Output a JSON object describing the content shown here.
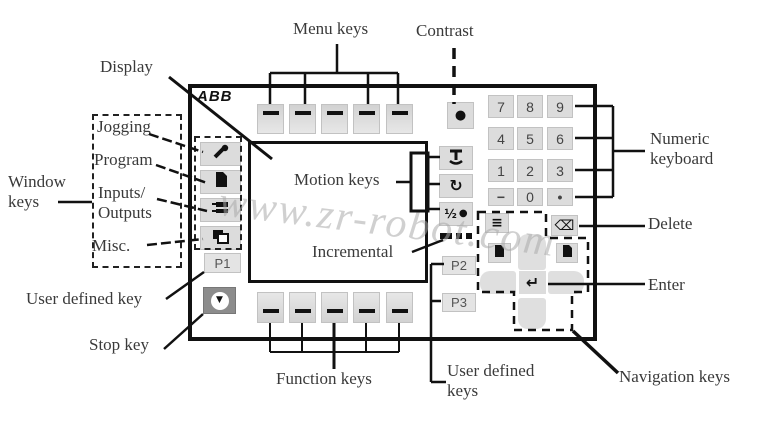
{
  "labels": {
    "display": "Display",
    "menu_keys": "Menu keys",
    "contrast": "Contrast",
    "window_keys_1": "Window",
    "window_keys_2": "keys",
    "jogging": "Jogging",
    "program": "Program",
    "inputs_outputs_1": "Inputs/",
    "inputs_outputs_2": "Outputs",
    "misc": "Misc.",
    "user_defined_key": "User defined key",
    "stop_key": "Stop key",
    "function_keys": "Function keys",
    "motion_keys": "Motion keys",
    "incremental": "Incremental",
    "user_defined_keys_1": "User defined",
    "user_defined_keys_2": "keys",
    "numeric_keyboard_1": "Numeric",
    "numeric_keyboard_2": "keyboard",
    "delete": "Delete",
    "enter": "Enter",
    "navigation_keys": "Navigation keys"
  },
  "watermark": "www.zr-robot.com",
  "logo": "ABB",
  "pendant": {
    "p_keys": [
      "P1",
      "P2",
      "P3"
    ],
    "keypad": [
      "7",
      "8",
      "9",
      "4",
      "5",
      "6",
      "1",
      "2",
      "3",
      "−",
      "0",
      "•"
    ],
    "icons": {
      "contrast": "●",
      "enter": "↵",
      "delete": "⌫",
      "list": "≡",
      "reorient": "↻",
      "axis_half": "½",
      "axis_dot": "●",
      "stop": "▼"
    }
  },
  "colors": {
    "key_bg": "#dcdcdc",
    "stop_key_bg": "#8c8c8c",
    "line": "#111111",
    "label_text": "#3a3a3a",
    "watermark": "#aaaaaa"
  }
}
